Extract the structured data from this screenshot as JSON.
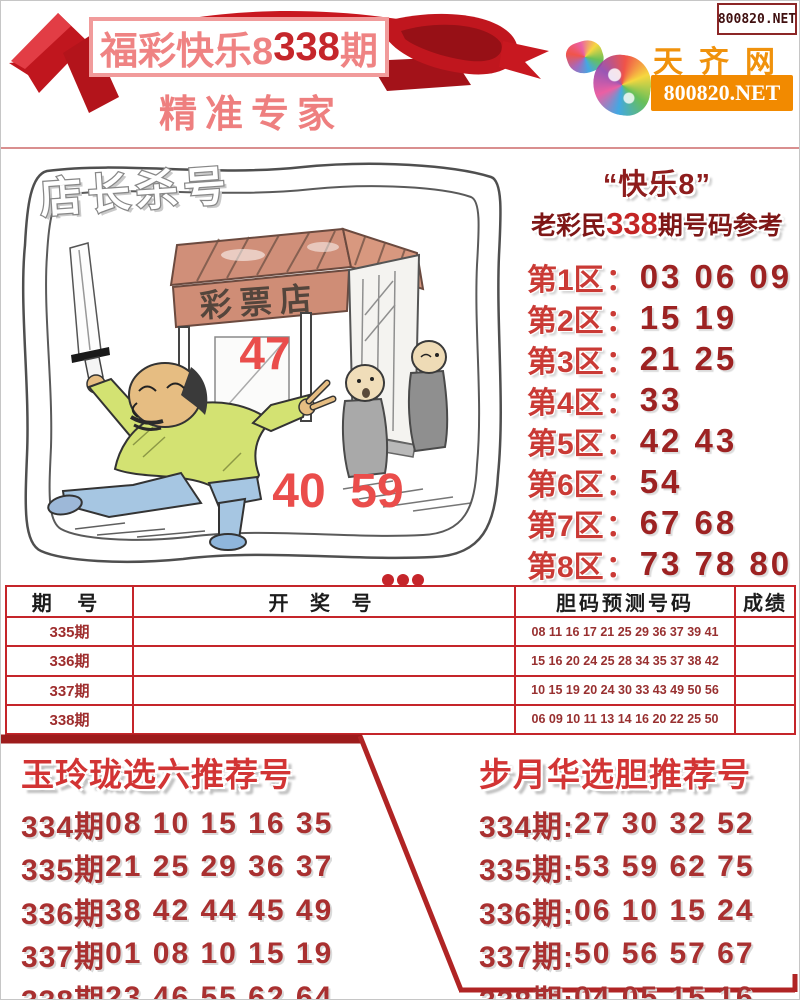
{
  "page": {
    "corner_site": "800820.NET"
  },
  "colors": {
    "ribbon_red": "#c0161e",
    "title_pink": "#ef8383",
    "issue_red": "#c5262b",
    "table_border_red": "#c5252a",
    "dark_red_text": "#9d2222",
    "logo_orange": "#f28a00"
  },
  "banner": {
    "title_prefix": "福彩快乐8",
    "title_issue": "338",
    "title_suffix": "期",
    "subtitle": "精准专家"
  },
  "logo": {
    "site_name": "天齐网",
    "site_url": "800820.NET"
  },
  "cartoon": {
    "caption": "店长杀号",
    "shop_sign": "彩票店",
    "numbers": [
      "47",
      "40",
      "59"
    ]
  },
  "prediction_panel": {
    "title_line1": "“快乐8”",
    "title_line2_prefix": "老彩民",
    "title_line2_issue": "338",
    "title_line2_suffix": "期号码参考",
    "colon": "：",
    "zones": [
      {
        "label": "第1区",
        "numbers": "03 06 09"
      },
      {
        "label": "第2区",
        "numbers": "15 19"
      },
      {
        "label": "第3区",
        "numbers": "21 25"
      },
      {
        "label": "第4区",
        "numbers": "33"
      },
      {
        "label": "第5区",
        "numbers": "42 43"
      },
      {
        "label": "第6区",
        "numbers": "54"
      },
      {
        "label": "第7区",
        "numbers": "67 68"
      },
      {
        "label": "第8区",
        "numbers": "73 78 80"
      }
    ]
  },
  "results_table": {
    "headers": [
      "期 号",
      "开 奖 号",
      "胆码预测号码",
      "成绩"
    ],
    "rows": [
      {
        "issue": "335期",
        "draw": "",
        "predict": "08 11 16 17 21 25 29 36 37 39 41",
        "score": ""
      },
      {
        "issue": "336期",
        "draw": "",
        "predict": "15 16 20 24 25 28 34 35 37 38 42",
        "score": ""
      },
      {
        "issue": "337期",
        "draw": "",
        "predict": "10 15 19 20 24 30 33 43 49 50 56",
        "score": ""
      },
      {
        "issue": "338期",
        "draw": "",
        "predict": "06 09 10 11 13 14 16 20 22 25 50",
        "score": ""
      }
    ]
  },
  "recommend_left": {
    "title": "玉玲珑选六推荐号",
    "rows": [
      {
        "issue": "334期",
        "numbers": "08 10 15 16 35"
      },
      {
        "issue": "335期",
        "numbers": "21 25 29 36 37"
      },
      {
        "issue": "336期",
        "numbers": "38 42 44 45 49"
      },
      {
        "issue": "337期",
        "numbers": "01 08 10 15 19"
      },
      {
        "issue": "338期",
        "numbers": "23 46 55 62 64"
      }
    ]
  },
  "recommend_right": {
    "title": "步月华选胆推荐号",
    "rows": [
      {
        "issue": "334期:",
        "numbers": "27 30 32 52"
      },
      {
        "issue": "335期:",
        "numbers": "53 59 62 75"
      },
      {
        "issue": "336期:",
        "numbers": "06 10 15 24"
      },
      {
        "issue": "337期:",
        "numbers": "50 56 57 67"
      },
      {
        "issue": "338期:",
        "numbers": "04 05 15 16"
      }
    ]
  }
}
